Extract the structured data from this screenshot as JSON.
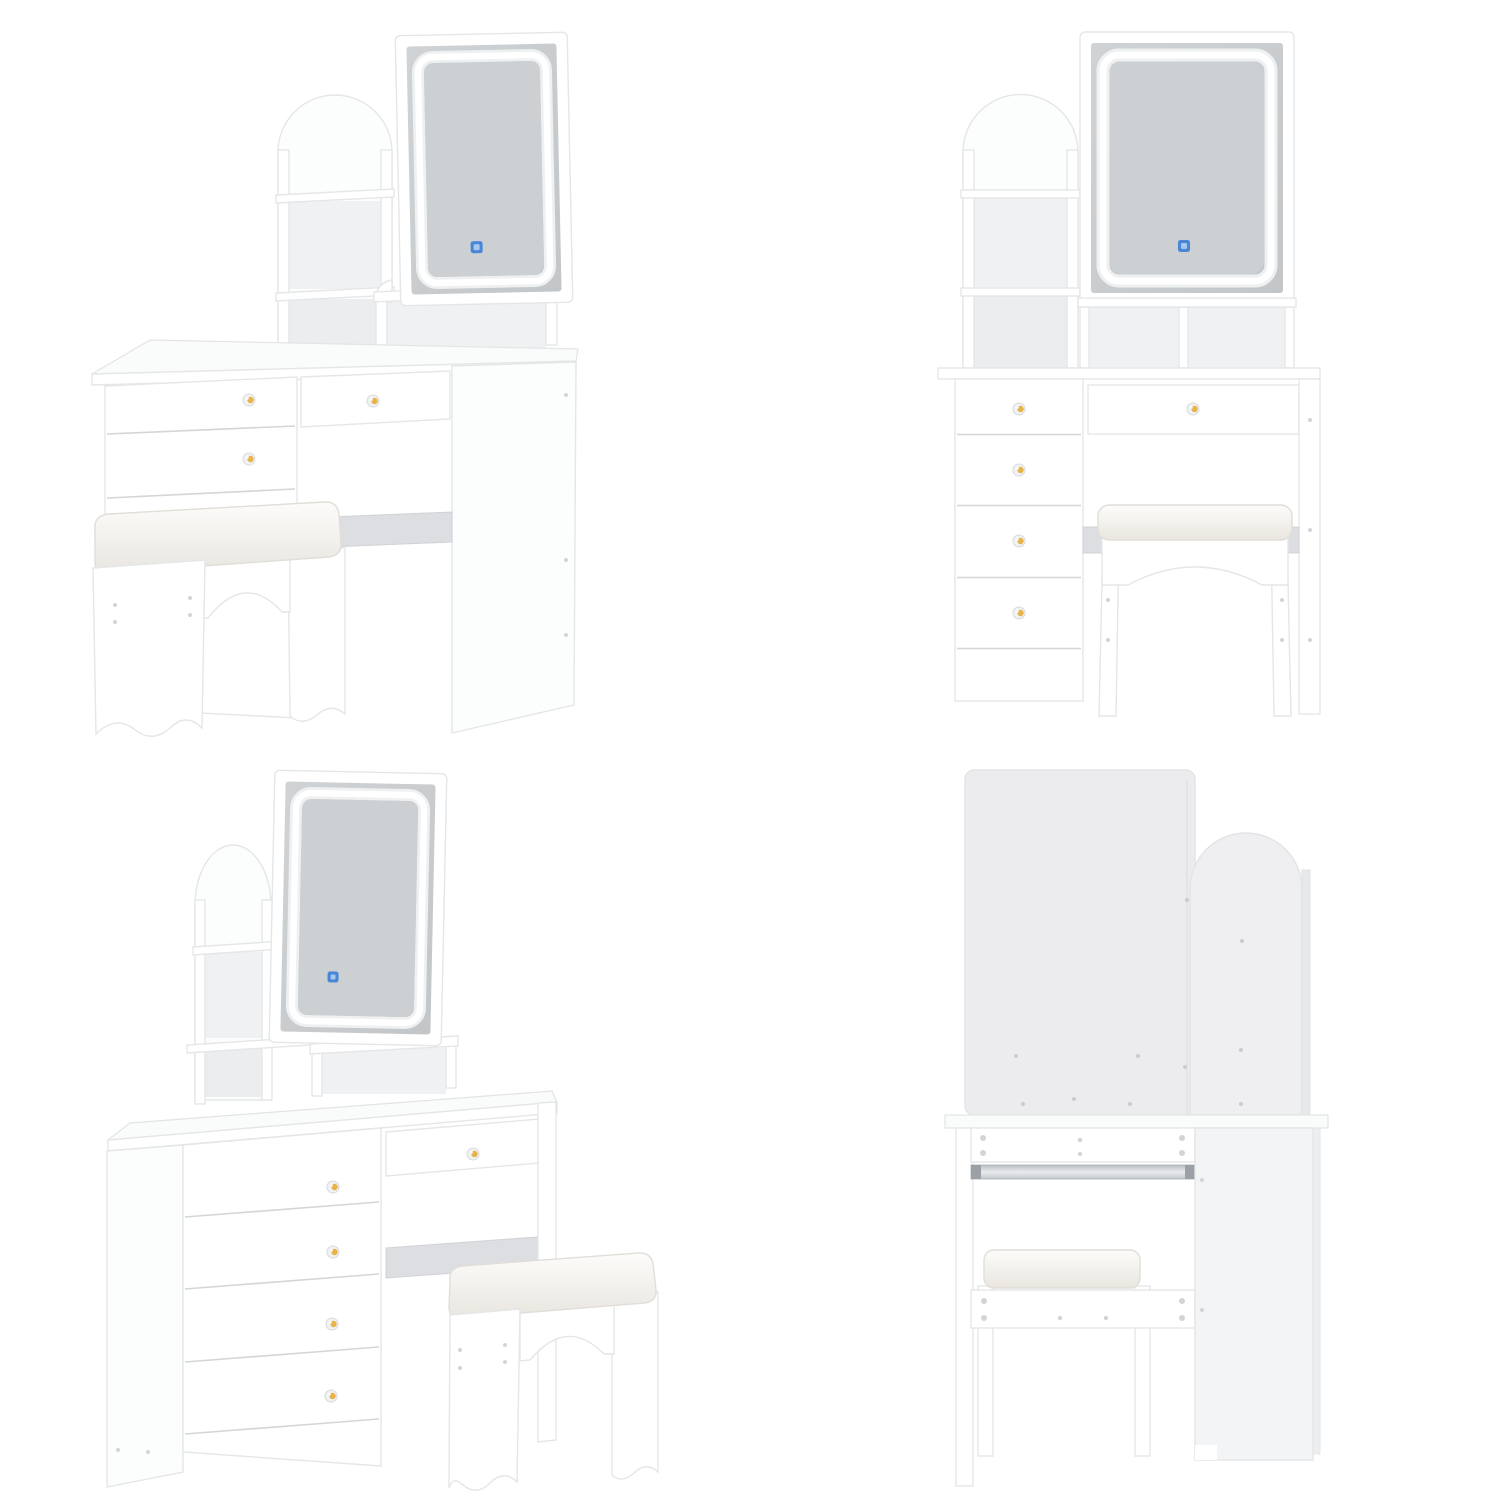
{
  "page": {
    "background": "#ffffff",
    "description": "Four-view product image of a white vanity dressing table set with arched storage tower, LED touch mirror, five drawers and a cushioned stool"
  },
  "views": [
    {
      "position": "top-left",
      "name": "angled-left-view",
      "mirror_touch_icon": true,
      "visible_drawer_knobs": 3
    },
    {
      "position": "top-right",
      "name": "front-view",
      "mirror_touch_icon": true,
      "visible_drawer_knobs": 5
    },
    {
      "position": "bottom-left",
      "name": "angled-right-view",
      "mirror_touch_icon": true,
      "visible_drawer_knobs": 5
    },
    {
      "position": "bottom-right",
      "name": "back-view",
      "mirror_touch_icon": false,
      "visible_drawer_knobs": 0
    }
  ],
  "colors": {
    "panel_white": "#ffffff",
    "panel_outline": "#e4e6e8",
    "seam": "#d4d7d9",
    "interior_shadow": "#f0f1f3",
    "mirror_glass_light": "#ced1d3",
    "mirror_glass_dark": "#c3c6c8",
    "led_ring": "#ffffff",
    "led_halo": "#eef0f1",
    "touch_icon": "#4a86d8",
    "touch_icon_inner": "#a9c7ed",
    "knob_base": "#f1f2f3",
    "knob_gold": "#e7b34a",
    "cushion_top": "#fdfcfa",
    "cushion_bottom": "#e9e6e0",
    "crossbar_gray": "#dcdee1",
    "slide_rail_dark": "#9aa0a5",
    "slide_rail_light": "#e9ebed",
    "screw_dot": "#d2d5d8",
    "back_panel": "#ececee",
    "back_panel_arch": "#efeff1"
  },
  "icons": [
    {
      "name": "touch-sensor-icon",
      "meaning": "LED mirror touch control",
      "color": "#4a86d8"
    }
  ]
}
